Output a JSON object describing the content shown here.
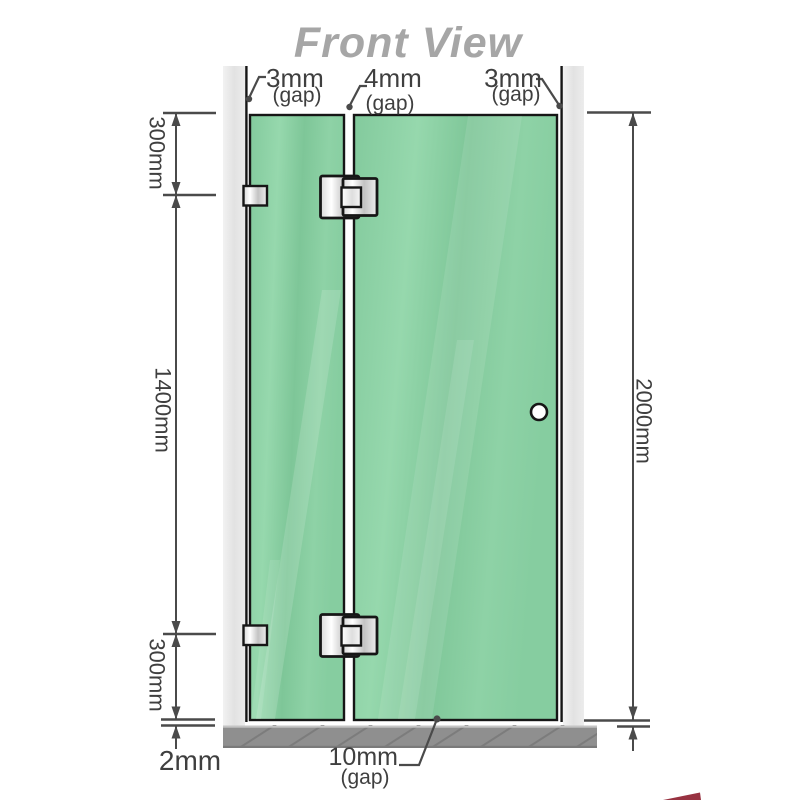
{
  "title": "Front View",
  "gap_annotations": {
    "top_left": {
      "value": "3mm",
      "label": "(gap)"
    },
    "top_middle": {
      "value": "4mm",
      "label": "(gap)"
    },
    "top_right": {
      "value": "3mm",
      "label": "(gap)"
    },
    "bottom": {
      "value": "10mm",
      "label": "(gap)"
    }
  },
  "dimensions": {
    "left_top": "300mm",
    "left_middle": "1400mm",
    "left_bottom": "300mm",
    "floor_clearance": "2mm",
    "overall_height": "2000mm"
  },
  "colors": {
    "glass_green": "#87cfa1",
    "wall_channel_gray": "#e8e8e8",
    "floor_gray": "#8f8f8f",
    "dimension_gray": "#3f3f3f",
    "title_gray": "#a6a6a6",
    "outline_black": "#161616"
  }
}
